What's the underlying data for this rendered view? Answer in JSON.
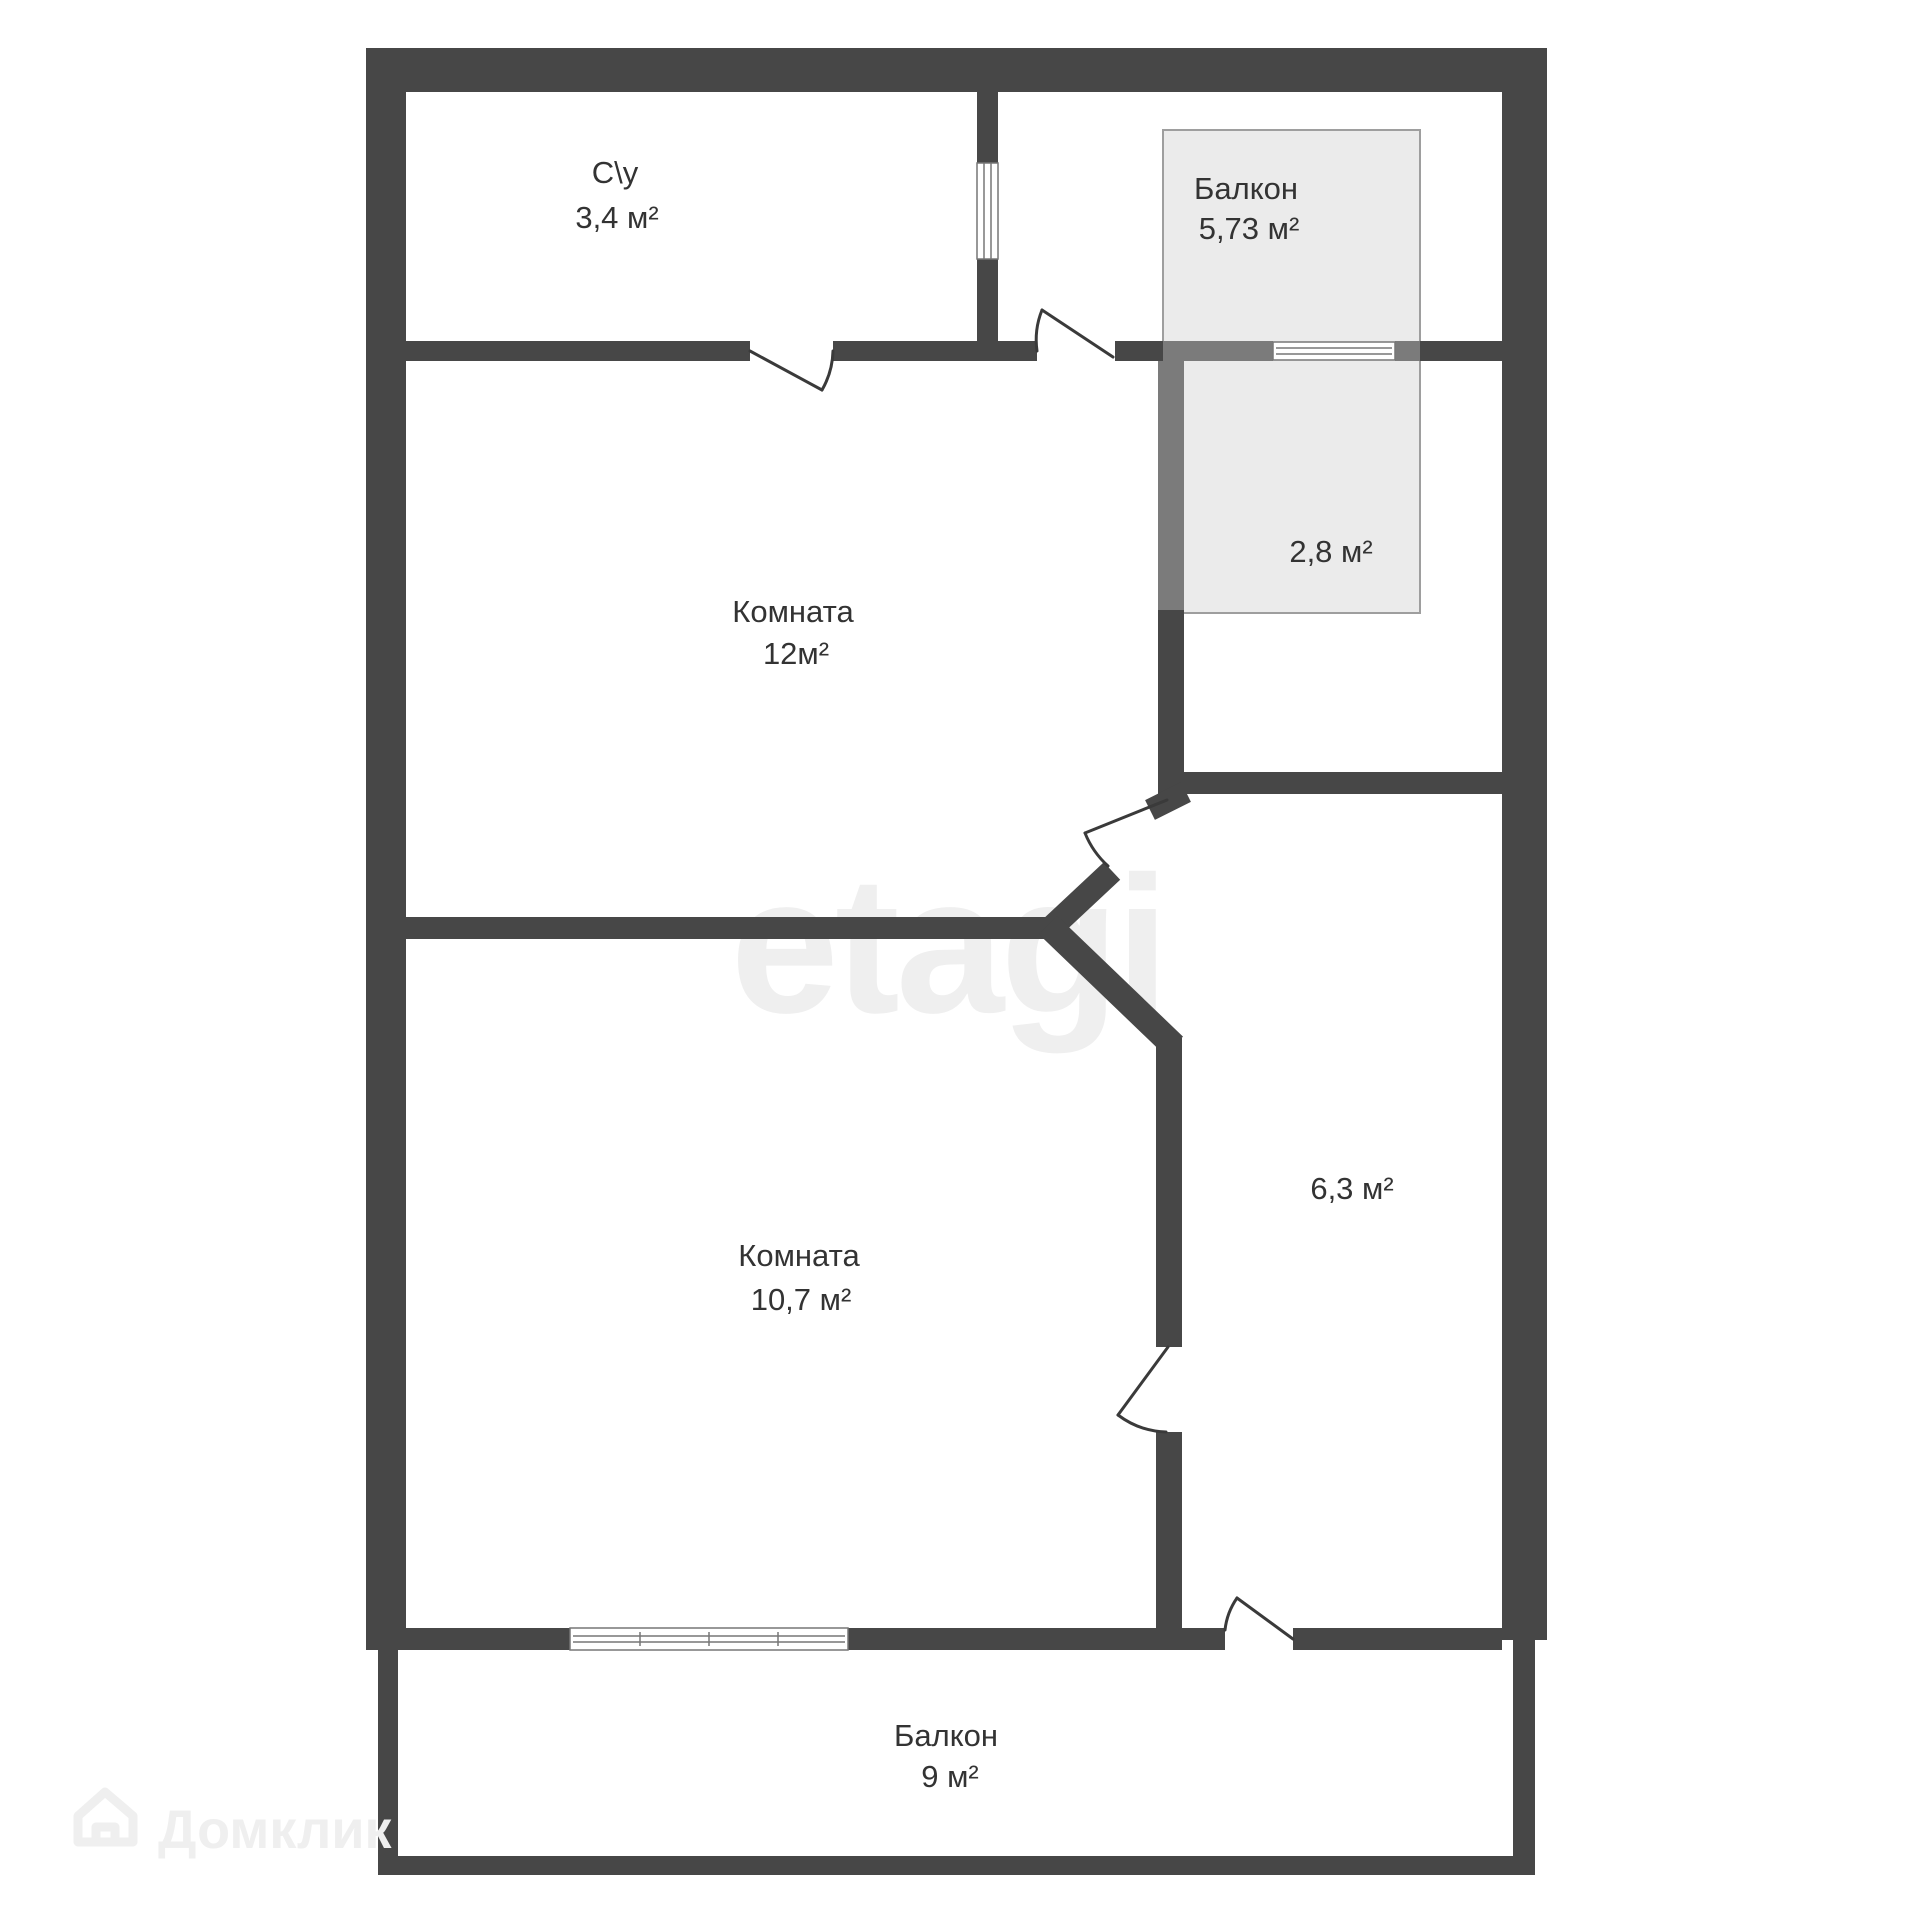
{
  "plan": {
    "rooms": [
      {
        "id": "su",
        "name": "С\\у",
        "area": "3,4 м²"
      },
      {
        "id": "balcony-top",
        "name": "Балкон",
        "area": "5,73 м²"
      },
      {
        "id": "niche",
        "name": "",
        "area": "2,8 м²"
      },
      {
        "id": "room-12",
        "name": "Комната",
        "area": "12м²"
      },
      {
        "id": "room-10-7",
        "name": "Комната",
        "area": "10,7 м²"
      },
      {
        "id": "hall",
        "name": "",
        "area": "6,3 м²"
      },
      {
        "id": "balcony-9",
        "name": "Балкон",
        "area": "9 м²"
      }
    ],
    "watermark": "etagi",
    "logo_text": "Домклик",
    "colors": {
      "wall": "#474747",
      "wall_over_balcony": "#7b7b7b",
      "balcony_fill": "#ebebeb",
      "balcony_border": "#9e9e9e",
      "label_text": "#333333",
      "watermark_text": "#efefef",
      "background": "#ffffff"
    }
  }
}
